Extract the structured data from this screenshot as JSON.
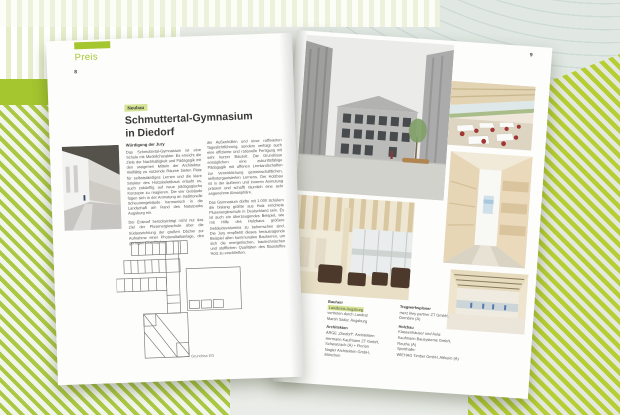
{
  "colors": {
    "brand_green": "#a5c62f",
    "highlight_green": "#d6e595",
    "text_dark": "#3c3b38",
    "text_body": "#55544f"
  },
  "left_page": {
    "section_label": "Preis",
    "page_number": "8",
    "tag": "Neubau",
    "title_line1": "Schmuttertal-Gymnasium",
    "title_line2": "in Diedorf",
    "jury": {
      "heading": "Würdigung der Jury",
      "col1_p1": "Das Schmuttertal-Gymnasium ist eine Schule mit Modellcharakter. Es erreicht die Ziele der Nachhaltigkeit und Pädagogik mit den ureigenen Mitteln der Architektur. Vielfältig zu nutzende Räume bieten Platz für selbstständiges Lernen und die klare Struktur des Holzskelettbaus erlaubt es, auch zukünftig auf neue pädagogische Konzepte zu reagieren. Die vier Gebäude fügen sich in der Anmutung an traditionelle Scheunengebäude harmonisch in die Landschaft am Rand des Naturparks Augsburg ein.",
      "col1_p2": "Der Entwurf berücksichtigt nicht nur das Ziel der Plusenergieschule über die Südausrichtung der großen Dächer zur Aufnahme einer Photovoltaikanlage, den geringen Oberflächen",
      "col2_p1": "der Außenhüllen und einer raffinierten Tageslichtführung, sondern verfolgt auch eine effiziente und rationelle Fertigung mit sehr kurzer Bauzeit. Die Grundrisse ermöglichen eine zukunftsfähige Pädagogik mit offenen Lernlandschaften zur Verwirklichung gemeinschaftlichen, selbstorganisierten Lernens. Der Holzbau ist in der äußeren und inneren Anmutung präsent und schafft räumlich eine sehr angenehme Atmosphäre.",
      "col2_p2": "Das Gymnasium dürfte mit 1.000 Schülern die bislang größte aus Holz errichtete Plusenergieschule in Deutschland sein. Es ist auch ein überzeugendes Beispiel, wie mit Hilfe des Holzbaus größere Gebäudevolumina zu beherrschen sind. Die Jury empfiehlt dieses herausragende Beispiel allen kommunalen Bauherren, um sich die energetischen, bautechnischen und stofflichen Qualitäten des Baustoffes Holz zu erschließen."
    },
    "plan_caption": "Grundriss EG"
  },
  "right_page": {
    "page_number": "9",
    "credits": {
      "bauherr_heading": "Bauherr",
      "bauherr_line1": "Landkreis Augsburg",
      "bauherr_line2": "vertreten durch Landrat",
      "bauherr_line3": "Martin Sailer, Augsburg",
      "architekten_heading": "Architekten",
      "architekten_line1": "ARGE „Diedorf“: Architekten",
      "architekten_line2": "Hermann Kaufmann ZT GmbH,",
      "architekten_line3": "Schwarzach (A) + Florian",
      "architekten_line4": "Nagler Architekten GmbH,",
      "architekten_line5": "München",
      "tragwerk_heading": "Tragwerksplaner",
      "tragwerk_line1": "merz kley partner ZT GmbH,",
      "tragwerk_line2": "Dornbirn (A)",
      "holzbau_heading": "Holzbau",
      "holzbau_line1": "Klassenhäuser und Aula:",
      "holzbau_line2": "Kaufmann Bausysteme GmbH,",
      "holzbau_line3": "Reuthe (A)",
      "holzbau_line4": "Sporthalle:",
      "holzbau_line5": "WIEHAG Timber GmbH, Altheim (A)"
    }
  }
}
